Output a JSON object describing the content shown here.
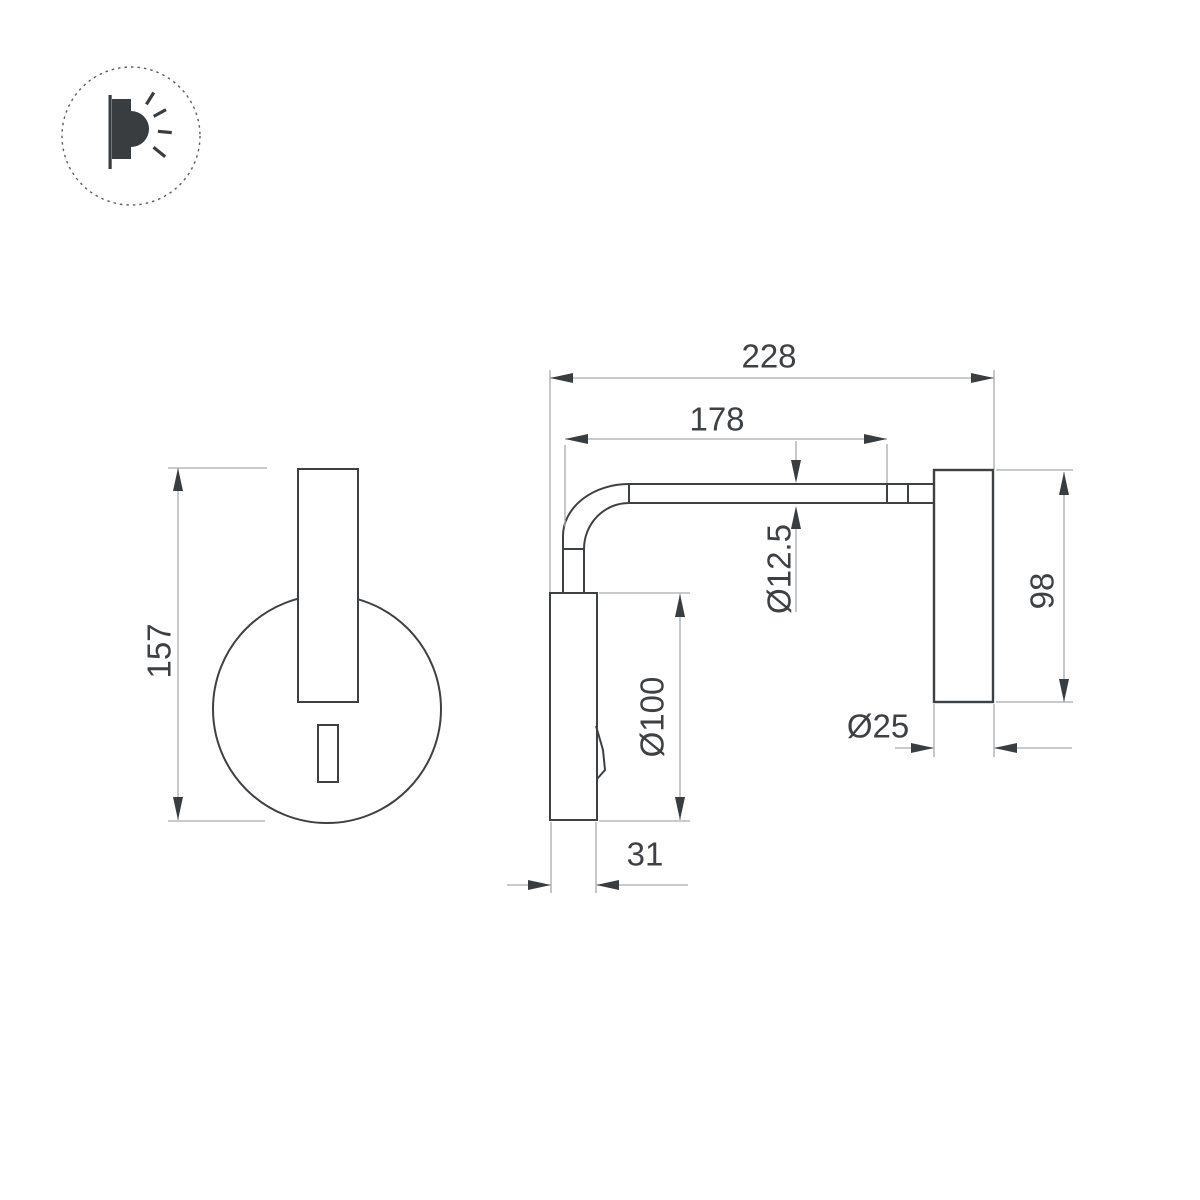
{
  "colors": {
    "background": "#ffffff",
    "outline": "#3e4144",
    "dimension_line": "#a9abad",
    "label_text": "#3e4144"
  },
  "logo": {
    "icon": "wall-lamp-shining-icon"
  },
  "front_view": {
    "height_label": "157"
  },
  "side_view": {
    "total_depth_label": "228",
    "arm_length_label": "178",
    "tube_diameter_label": "Ø12.5",
    "backplate_height_label": "98",
    "head_length_label": "Ø100",
    "backplate_depth_label": "Ø25",
    "head_width_label": "31"
  }
}
